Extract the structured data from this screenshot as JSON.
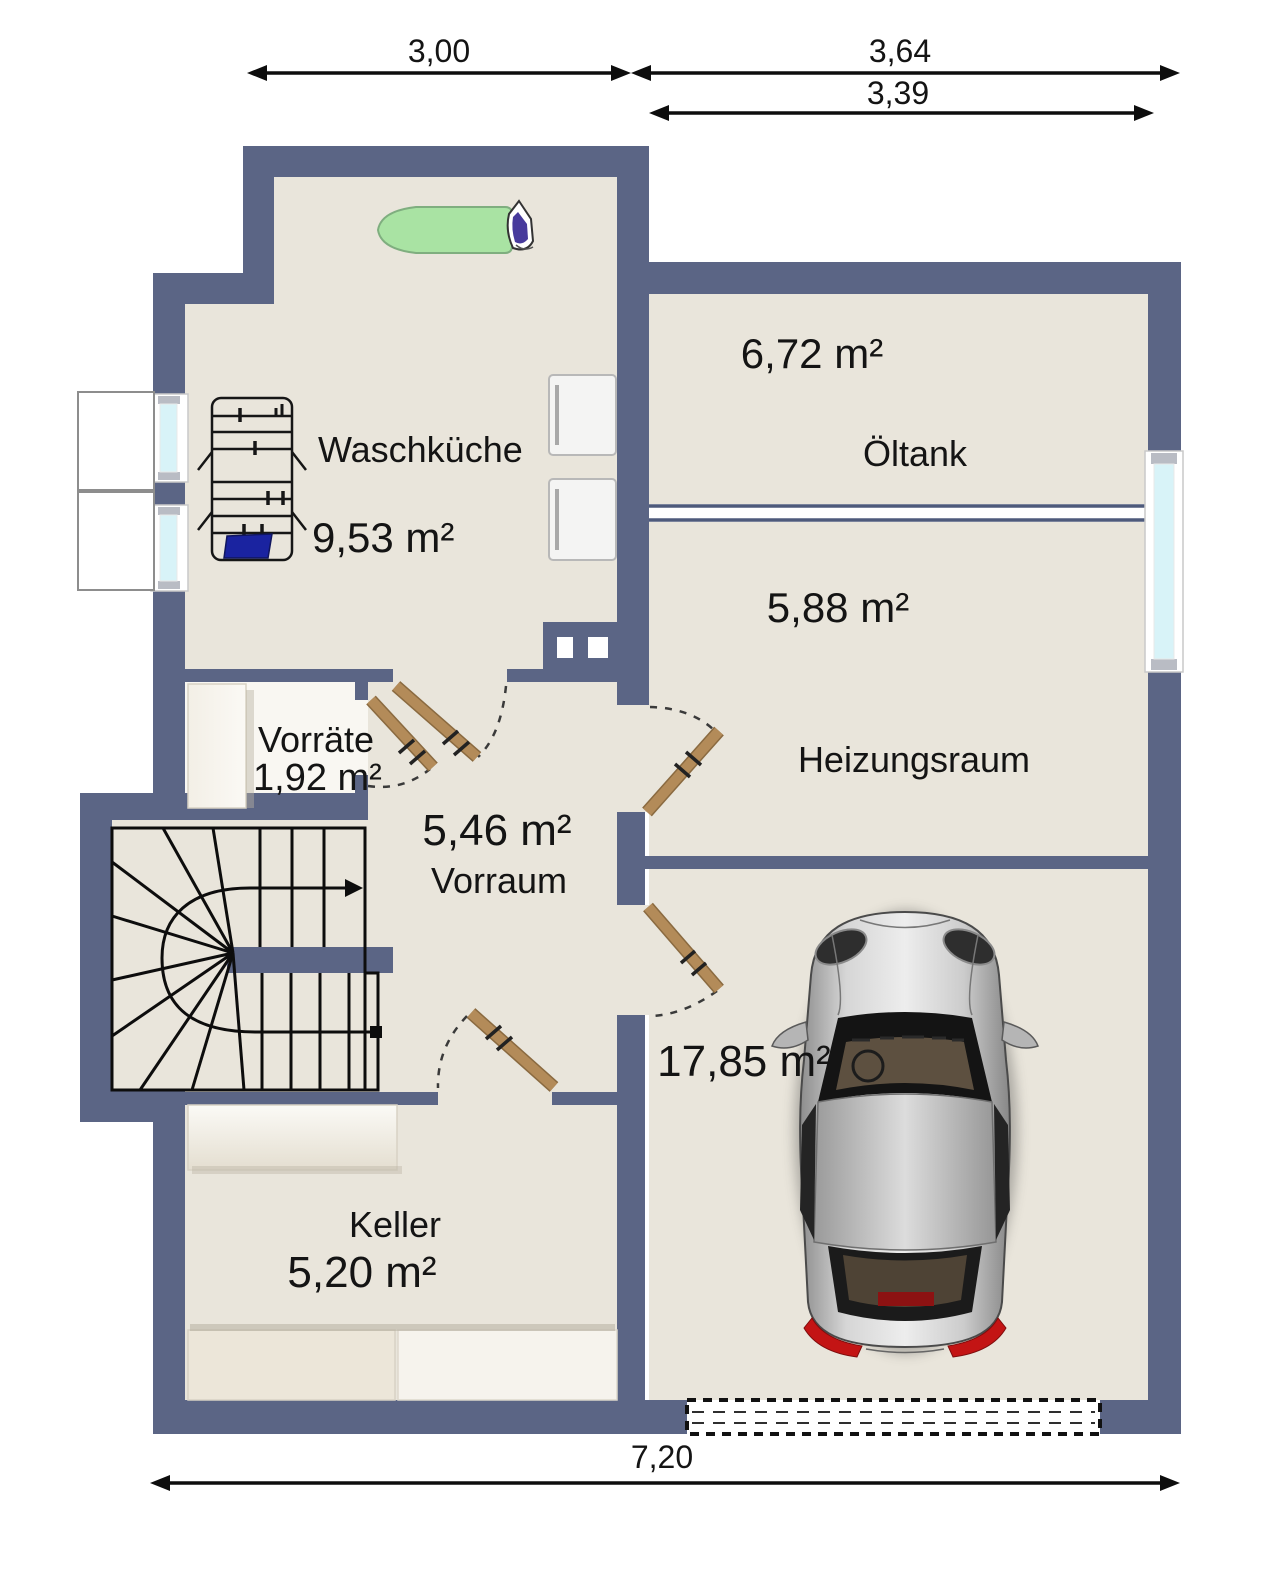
{
  "rooms": {
    "waschkueche": {
      "name": "Waschküche",
      "area": "9,53 m²"
    },
    "oeltank": {
      "name": "Öltank",
      "area": "6,72 m²"
    },
    "heizungsraum": {
      "name": "Heizungsraum",
      "area": "5,88 m²"
    },
    "vorraete": {
      "name": "Vorräte",
      "area": "1,92 m²"
    },
    "vorraum": {
      "name": "Vorraum",
      "area": "5,46 m²"
    },
    "garage": {
      "area": "17,85 m²"
    },
    "keller": {
      "name": "Keller",
      "area": "5,20 m²"
    }
  },
  "dimensions": {
    "top_left": "3,00",
    "top_right": "3,64",
    "top_right_inner": "3,39",
    "bottom": "7,20"
  },
  "objects": [
    "ironing-board-icon",
    "iron-icon",
    "drying-rack-icon",
    "towel-icon",
    "washing-machine-icon",
    "dryer-icon",
    "shelf-icon",
    "staircase-icon",
    "walking-line-icon",
    "chimney-icon",
    "door-leaf-icon",
    "door-swing-icon",
    "window-icon",
    "light-well-icon",
    "car-icon",
    "garage-door-icon"
  ],
  "colors": {
    "wall": "#5b6585",
    "floor": "#e9e5db",
    "vorraete_floor": "#f9f7f2",
    "glass": "#d8f3f8",
    "door_leaf": "#b38b59",
    "ironing_board": "#a9e3a3",
    "towel": "#1a23a0"
  }
}
